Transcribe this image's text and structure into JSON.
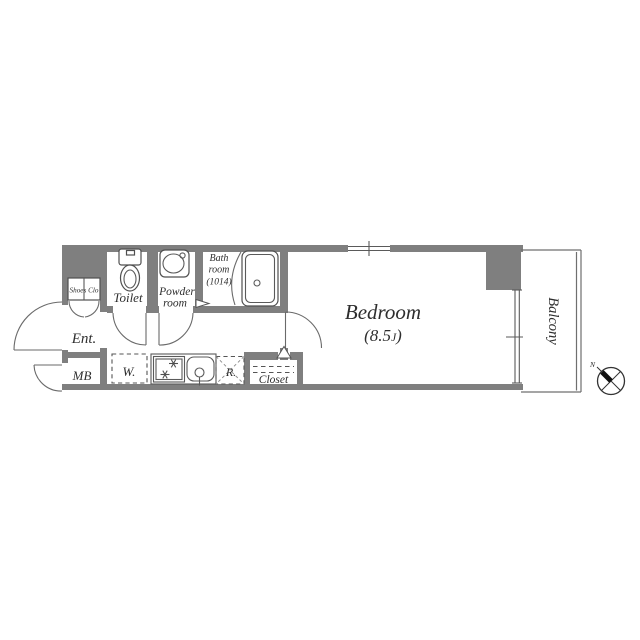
{
  "title": "apartment-floor-plan",
  "colors": {
    "wall": "#7f7f7f",
    "line": "#4f4f4f",
    "text": "#2e2e2e",
    "background": "#ffffff"
  },
  "rooms": {
    "shoes_closet": {
      "label": "Shoes Clo"
    },
    "toilet": {
      "label": "Toilet"
    },
    "powder_room": {
      "label_line1": "Powder",
      "label_line2": "room"
    },
    "bath_room": {
      "label_line1": "Bath",
      "label_line2": "room",
      "label_line3": "(1014)"
    },
    "entrance": {
      "label": "Ent."
    },
    "meter_box": {
      "label": "MB"
    },
    "washer_space": {
      "label": "W."
    },
    "refrigerator_space": {
      "label": "R."
    },
    "closet": {
      "label": "Closet"
    },
    "bedroom": {
      "label": "Bedroom",
      "size_prefix": "(8.5",
      "size_unit": "J",
      "size_suffix": ")"
    },
    "balcony": {
      "label": "Balcony"
    }
  },
  "compass": {
    "north_label": "N"
  }
}
